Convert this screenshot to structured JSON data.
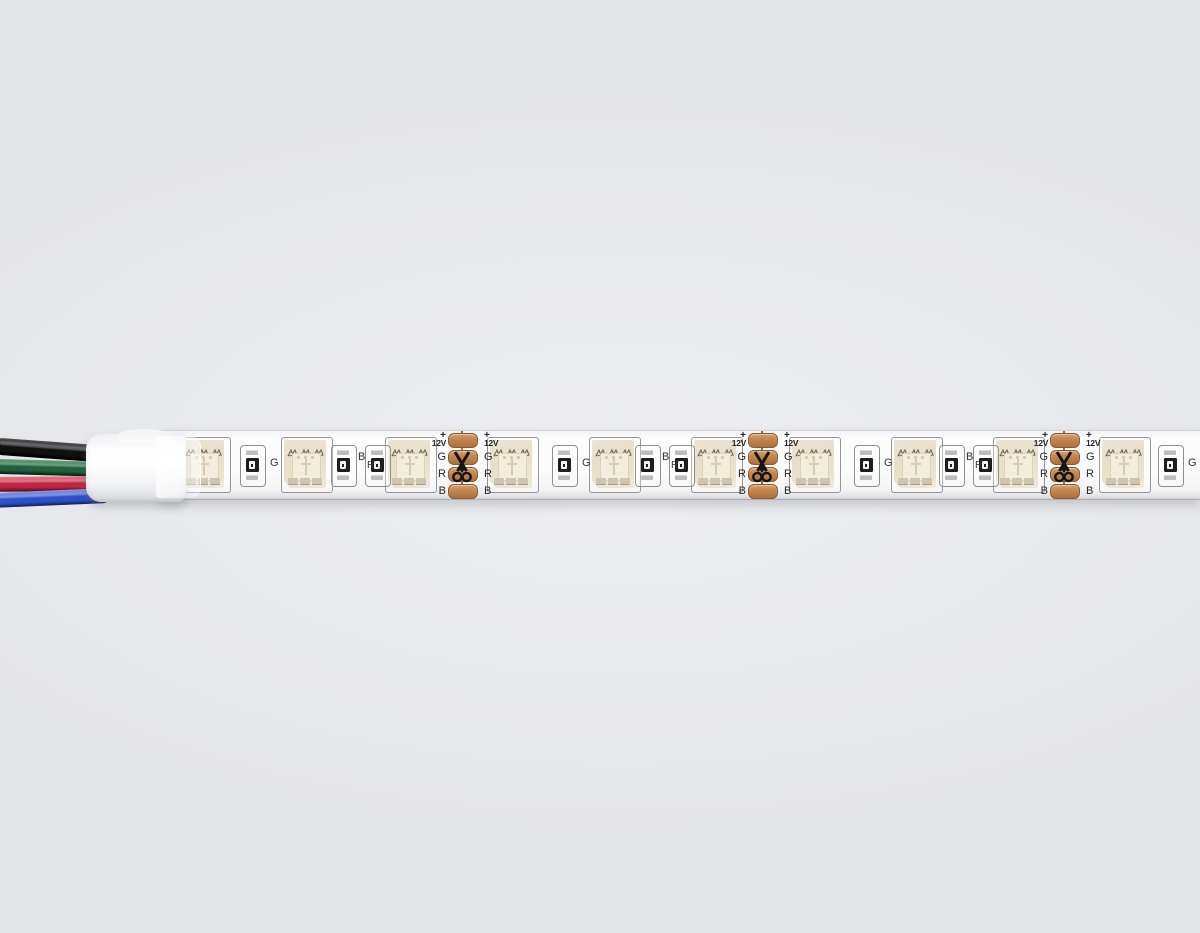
{
  "scene": {
    "description": "Product photo of a white 12V SMD5050 RGB LED strip lying horizontally on a plain light-gray background; a 4-conductor lead wire enters a white heat-shrink sleeve at the left end.",
    "background_color": "#e6e7ea"
  },
  "wires": [
    {
      "name": "black-wire",
      "color": "#101010",
      "edge": "#000000",
      "highlight": "#555555"
    },
    {
      "name": "green-wire",
      "color": "#20603a",
      "edge": "#12301d",
      "highlight": "#6fa184"
    },
    {
      "name": "red-wire",
      "color": "#c02440",
      "edge": "#7c1322",
      "highlight": "#e8808d"
    },
    {
      "name": "blue-wire",
      "color": "#2b51c9",
      "edge": "#1b3489",
      "highlight": "#8aa0ea"
    }
  ],
  "sleeve": {
    "color": "#f6f7f9"
  },
  "strip": {
    "body_color": "#fbfbfa",
    "pad_color": "#c08354",
    "led_body_color": "#e9e1cc",
    "labels": {
      "plus": "+",
      "voltage": "12V",
      "green": "G",
      "red": "R",
      "blue": "B"
    },
    "components": {
      "leds": [
        204,
        306,
        410,
        512,
        614,
        716,
        814,
        916,
        1018,
        1124
      ],
      "g_resistors": [
        {
          "x": 252
        },
        {
          "x": 564
        },
        {
          "x": 866
        },
        {
          "x": 1170
        }
      ],
      "br_resistor_pairs": [
        {
          "bx": 343,
          "rx": 377
        },
        {
          "bx": 647,
          "rx": 681
        },
        {
          "bx": 951,
          "rx": 985
        }
      ],
      "cut_points": [
        462,
        762,
        1064
      ]
    }
  }
}
